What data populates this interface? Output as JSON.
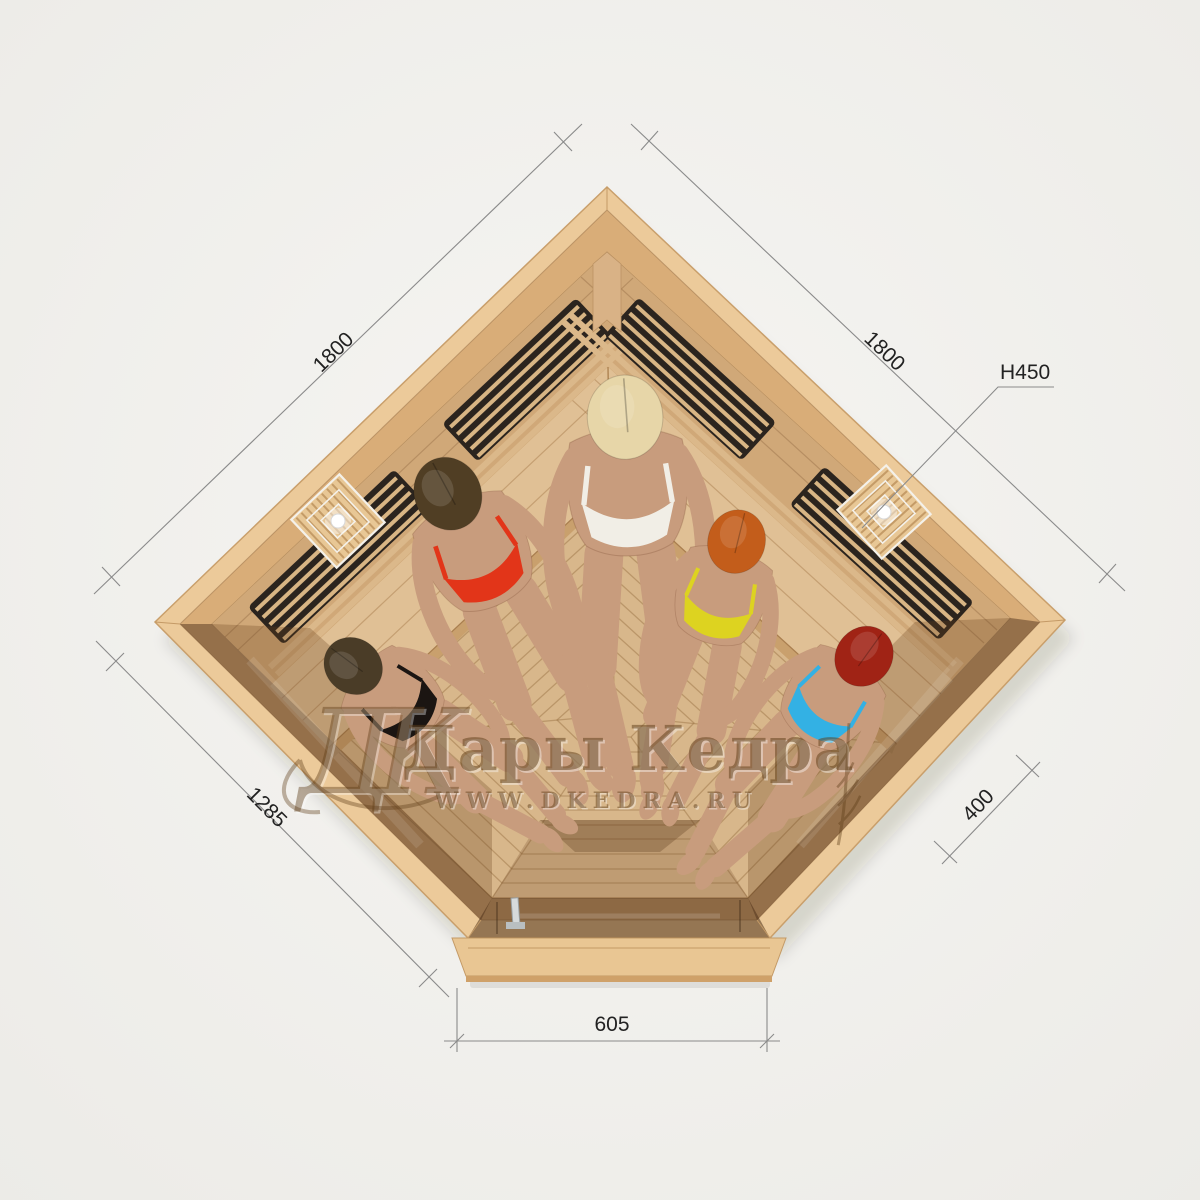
{
  "dimensions": {
    "top_left": "1800",
    "top_right": "1800",
    "height": "H450",
    "lower_left": "1285",
    "lower_right": "400",
    "door": "605"
  },
  "watermark": {
    "monogram": "ДК",
    "brand": "Дары Кедра",
    "site": "WWW.DKEDRA.RU"
  },
  "people": [
    {
      "position": "left-bench",
      "swimsuit": "black",
      "swimsuit_hex": "#1b1512",
      "hair": "dark-brown",
      "hair_hex": "#4a3c27"
    },
    {
      "position": "upper-left-bench",
      "swimsuit": "red",
      "swimsuit_hex": "#e23519",
      "hair": "dark-brown",
      "hair_hex": "#503e24"
    },
    {
      "position": "corner-top",
      "swimsuit": "white",
      "swimsuit_hex": "#f1eee6",
      "hair": "blonde",
      "hair_hex": "#e7d6a8"
    },
    {
      "position": "upper-right-bench",
      "swimsuit": "yellow",
      "swimsuit_hex": "#ddd320",
      "hair": "copper-orange",
      "hair_hex": "#c35d1b"
    },
    {
      "position": "right-bench",
      "swimsuit": "cyan-blue",
      "swimsuit_hex": "#33b1e4",
      "hair": "red",
      "hair_hex": "#a02315"
    }
  ],
  "colors": {
    "background": "#f2f1ee",
    "wood_cap": "#ecca9a",
    "wood_wall": "#d9ad78",
    "wood_lining": "#d0a878",
    "wood_floor": "#d8b78b",
    "wood_bench": "#e0c095",
    "heater_panel": "#2b241e",
    "heater_slat": "#d8b584",
    "floor_gap": "#a8845a",
    "glass_tint": "#4e3218",
    "lamp_wood": "#e8c795",
    "lamp_frame": "#f4f1ea",
    "handle_chrome": "#d6dadb",
    "dim_line": "#8a8a8a",
    "dim_text": "#222222",
    "watermark": "#5e3d18",
    "skin": "#c89c7d",
    "suit1": "#1b1512",
    "hair1": "#4a3c27",
    "suit2": "#e23519",
    "hair2": "#503e24",
    "suit3": "#f1eee6",
    "hair3": "#e7d6a8",
    "suit4": "#ddd320",
    "hair4": "#c35d1b",
    "suit5": "#33b1e4",
    "hair5": "#a02315"
  }
}
